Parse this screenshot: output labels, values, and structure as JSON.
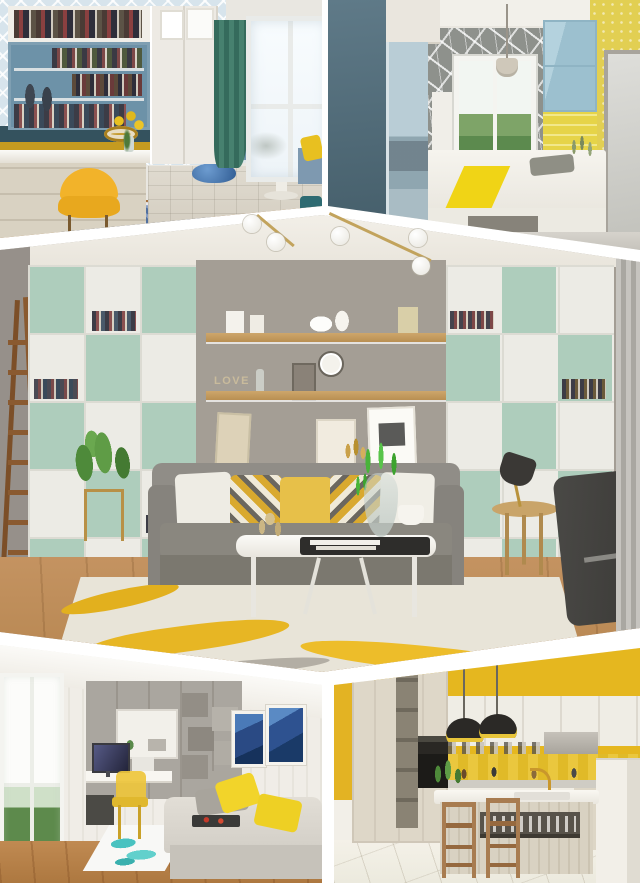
{
  "meta": {
    "type": "photo-collage",
    "subject": "Five interior-design renderings arranged with white chevron separators",
    "canvas": {
      "width": 640,
      "height": 883
    },
    "decor_text": "LOVE"
  },
  "collage": {
    "background_color": "#ffffff",
    "separator_style": "white angled bands forming a peak at top-center and an inverted peak at bottom-center",
    "lighting_overlay": "brass track lamp with five white globe bulbs crossing the upper white chevron",
    "photos": [
      {
        "id": "top-left",
        "name": "study-nook",
        "description": "Home office nook with steel-blue built-in bookshelves, white cabinets, lattice wallpaper, mustard and dark-teal accent bands, yellow shell chair at a white desk, dark green curtain beside a bright window, tatami platform with round pedestal table and blue bowl, round blue patterned rug on wood floor",
        "palette": {
          "shelf_blue": "#6d92a8",
          "accent_yellow": "#f2b32a",
          "curtain_green": "#3e7a69",
          "band_mustard": "#c59b20",
          "band_teal": "#34525e",
          "wood_floor": "#b9854f"
        }
      },
      {
        "id": "top-right",
        "name": "bedroom-platform",
        "description": "Compact bedroom with slate-blue wardrobe and mirror, gray crackle-mosaic wallpaper around a garden window, pendant lamp, light-blue overhead cabinet, textured yellow feature wall, glossy door, white platform bed with bright yellow runner and gray pillow",
        "palette": {
          "wardrobe_slate": "#5f7a88",
          "cabinet_blue": "#a6c6d4",
          "wall_yellow": "#e2cf52",
          "runner_yellow": "#f0d416",
          "mosaic_gray": "#8e918c"
        }
      },
      {
        "id": "middle",
        "name": "living-room-shelving-wall",
        "description": "Living room with full-wall mint-green and white cubby shelving flanking a warm gray alcove with two wood shelves, LOVE letters, wall clock and leaning artwork; gray fabric sofa with white, yellow and geometric cube-print cushions; white coffee table with black tray and glass vase of greenery; yellow brush-stroke rug on wood floor; wooden ladder, potted plant, round side table with black task lamp, dark desk chair and striped curtain",
        "decor_text": "LOVE",
        "palette": {
          "mint": "#aecdbc",
          "wall_gray": "#a49e95",
          "sofa_gray": "#8f8c86",
          "cushion_yellow": "#e7c049",
          "rug_yellow": "#e7b624",
          "wood_shelf": "#c9a469",
          "floor_wood": "#b5854f"
        }
      },
      {
        "id": "bottom-left",
        "name": "study-daybed-room",
        "description": "White panelled study with tall garden window, gray wall cabinets with staggered open boxes, built-in desk with monitor and translucent yellow chair, teal splash rug, platform daybed with gray and yellow cushions and dark snack tray, two blue framed artworks, wood floor",
        "palette": {
          "cabinet_gray": "#a9a59e",
          "chair_yellow": "#eec63c",
          "pillow_yellow": "#f2d42a",
          "rug_teal": "#49c2c0",
          "art_blue": "#2e5290",
          "floor_wood": "#b8834e"
        }
      },
      {
        "id": "bottom-right",
        "name": "yellow-kitchen",
        "description": "Kitchen with bold yellow walls and striped yellow backsplash, cream wood cabinetry with open cubby column and built-in oven, range hood, shelf of jars, white-topped island with gold faucet and plate niche, two wooden bar stools, two black dome pendant lamps with yellow interiors, glossy cream tile floor",
        "palette": {
          "wall_yellow": "#e5b71f",
          "cabinet_cream": "#dcd5c6",
          "pendant_black": "#2b2926",
          "pendant_inner_yellow": "#e8c53a",
          "stool_wood": "#a87c50",
          "floor_cream": "#f1eee5"
        }
      }
    ]
  }
}
